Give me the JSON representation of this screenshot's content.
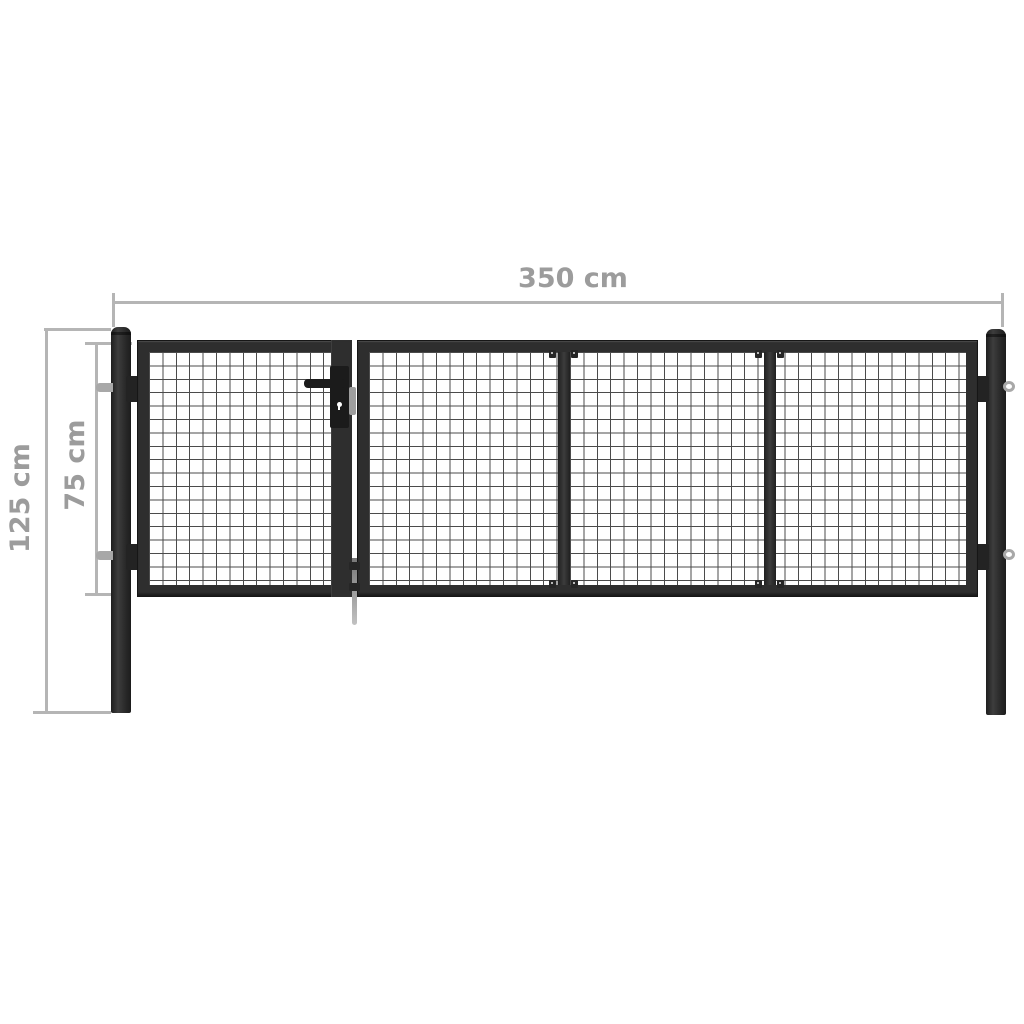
{
  "diagram": {
    "title": "mesh garden gate dimension diagram",
    "dimensions": {
      "width_label": "350 cm",
      "total_height_label": "125 cm",
      "gate_height_label": "75 cm"
    },
    "colors": {
      "background": "#ffffff",
      "frame": "#2e2e2e",
      "mesh_line": "#4b4b4b",
      "dimension_line": "#b5b5b5",
      "dimension_text": "#9c9c9c",
      "hardware": "#a8a8a8"
    }
  }
}
